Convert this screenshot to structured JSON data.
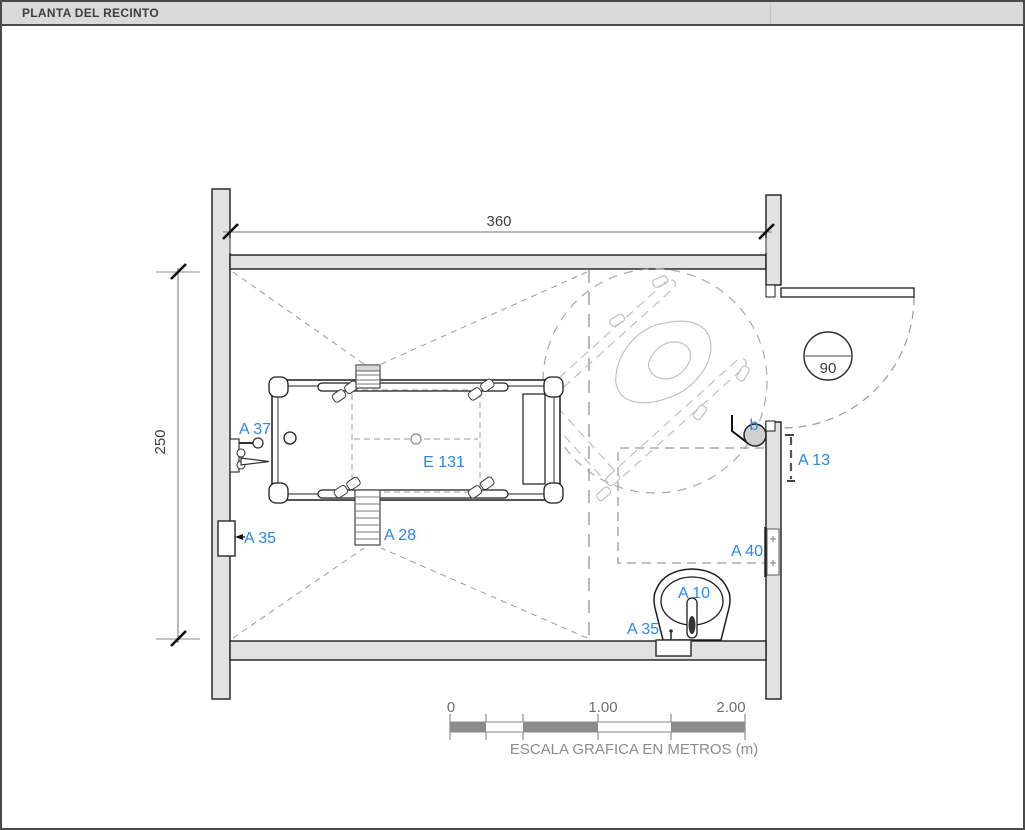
{
  "title_bar": {
    "title": "PLANTA DEL RECINTO"
  },
  "plan": {
    "dimensions": {
      "width": "360",
      "height": "250"
    },
    "door": {
      "width_label": "90"
    },
    "labels": {
      "faucet": "A 37",
      "niche_left": "A 35",
      "ladder": "A 28",
      "tub": "E 131",
      "grab_bar_right": "A 13",
      "wall_support": "A 40",
      "toilet": "A 10",
      "niche_bottom": "A 35",
      "hook": "b"
    },
    "colors": {
      "label_blue": "#2b87e3",
      "wall_fill": "#e2e2e2",
      "line_dark": "#1c1c1c",
      "dashed_gray": "#9a9a9a",
      "title_bg": "#d9d9d9"
    }
  },
  "scale_bar": {
    "tick_labels": [
      "0",
      "1.00",
      "2.00"
    ],
    "caption": "ESCALA GRAFICA EN METROS (m)"
  }
}
